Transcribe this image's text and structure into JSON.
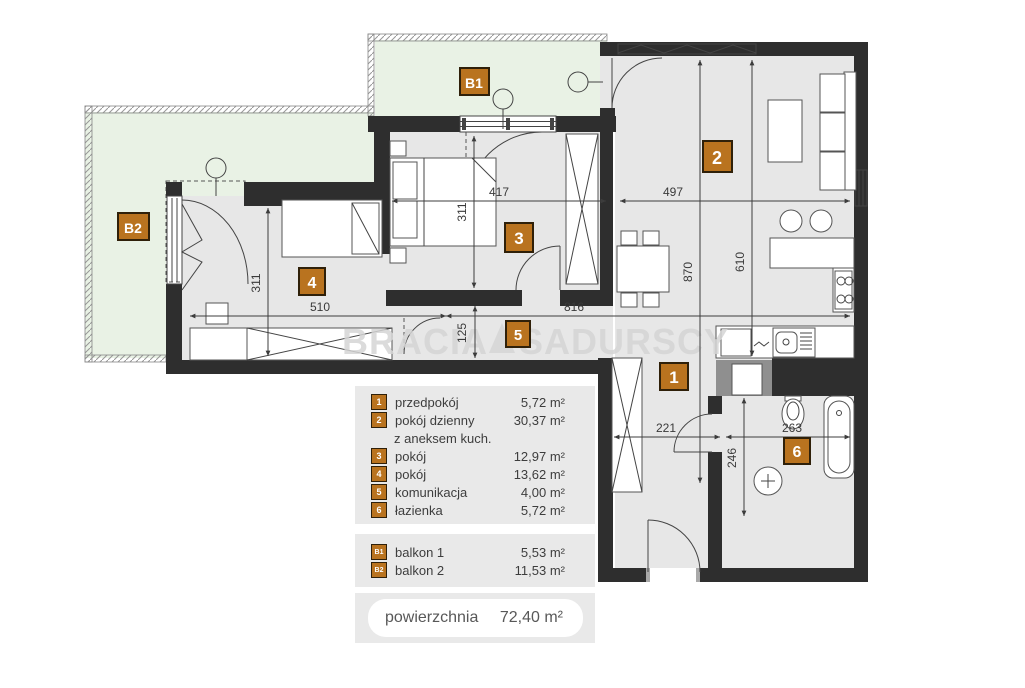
{
  "watermark": {
    "left": "BRACIA",
    "right": "SADURSCY"
  },
  "rooms": [
    {
      "id": "1",
      "name": "przedpokój",
      "area": "5,72 m²"
    },
    {
      "id": "2",
      "name": "pokój dzienny",
      "name2": "z aneksem kuch.",
      "area": "30,37 m²"
    },
    {
      "id": "3",
      "name": "pokój",
      "area": "12,97 m²"
    },
    {
      "id": "4",
      "name": "pokój",
      "area": "13,62 m²"
    },
    {
      "id": "5",
      "name": "komunikacja",
      "area": "4,00 m²"
    },
    {
      "id": "6",
      "name": "łazienka",
      "area": "5,72 m²"
    }
  ],
  "balconies": [
    {
      "id": "B1",
      "name": "balkon 1",
      "area": "5,53 m²"
    },
    {
      "id": "B2",
      "name": "balkon 2",
      "area": "11,53 m²"
    }
  ],
  "total": {
    "label": "powierzchnia",
    "value": "72,40 m²"
  },
  "dims": {
    "room3_width": "417",
    "living_width": "497",
    "room3_height": "311",
    "living_height": "870",
    "kitchen_height": "610",
    "room4_width": "510",
    "corridor_width": "816",
    "corridor_height": "125",
    "room4_height": "311",
    "hall_width": "221",
    "bath_width": "263",
    "hall_height": "246"
  },
  "colors": {
    "wall": "#2e2e2e",
    "floor": "#e7e7e7",
    "balcony": "#e9f2e5",
    "marker": "#b9731f",
    "marker_border": "#2f2009",
    "legend_bg": "#e9e9e9",
    "watermark": "#d5d5d5"
  }
}
